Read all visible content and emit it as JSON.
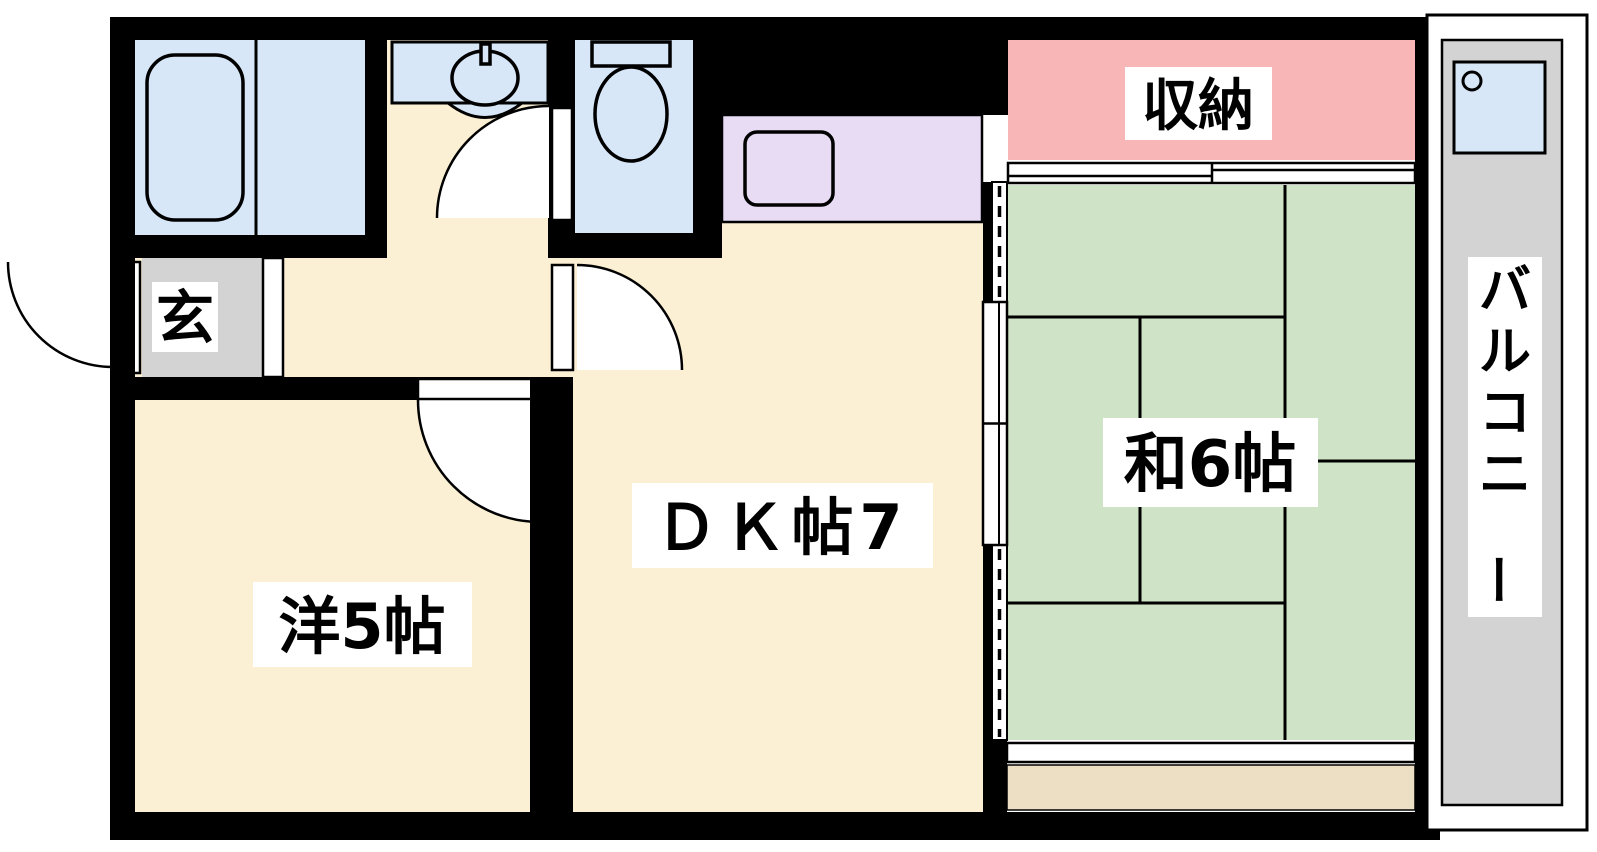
{
  "rooms": {
    "entrance": {
      "label": "玄"
    },
    "western_room": {
      "label": "洋5帖"
    },
    "dining_kitchen": {
      "label": "ＤＫ帖7"
    },
    "japanese_room": {
      "label": "和6帖"
    },
    "storage": {
      "label": "収納"
    },
    "balcony": {
      "label": "バルコニー"
    }
  },
  "colors": {
    "room_blue": "#d8e7f8",
    "floor_cream": "#fbf0d3",
    "tatami_green": "#cfe4c6",
    "storage_pink": "#f9b6b6",
    "kitchen_lavender": "#e8dcf5",
    "genkan_gray": "#d3d3d3",
    "balcony_gray": "#d3d3d3",
    "veranda_tan": "#ecdfc3",
    "wall_black": "#000000"
  }
}
